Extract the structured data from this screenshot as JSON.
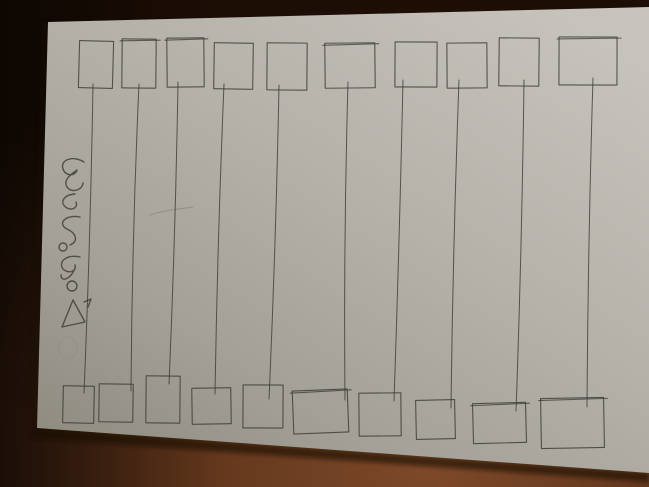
{
  "scene": {
    "description": "Photograph of a sheet of paper on a wooden table with a hand-drawn matching worksheet: ten squares along the top edge joined by long vertical pen lines to ten squares along the bottom edge; a small handwritten Sinhala label runs sideways in the left margin.",
    "handwriting": {
      "transcription": "ගලපමු",
      "script": "Sinhala",
      "orientation": "rotated 90° (reads along left margin)",
      "extra_marks": "small triangle with a tick flag, faint circle below"
    }
  },
  "colors": {
    "table_highlight": "#7d4929",
    "table_mid": "#5d3319",
    "table_dark": "#351c0d",
    "table_darkest": "#1d0e05",
    "paper_dark": "#8a877c",
    "paper_mid1": "#a3a098",
    "paper_mid2": "#b4b1a9",
    "paper_bright": "#c6c3bc",
    "ink": "#3b3a35",
    "ink_faint": "#8e8b82",
    "shadow": "#140a04"
  },
  "paper": {
    "corners": "48,22 649,7 649,473 37,428",
    "bottom_shadow": "37,428 649,473 649,482 29,438",
    "left_shadow": "48,22 37,428 29,426 42,23"
  },
  "drawing": {
    "box_format": "x,y,w,h,rotation_deg,double_top_stroke",
    "top_boxes": [
      [
        79,
        41,
        34,
        47,
        1.5,
        0
      ],
      [
        122,
        39,
        34,
        49,
        0.5,
        1
      ],
      [
        167,
        38,
        37,
        49,
        -0.5,
        1
      ],
      [
        214,
        43,
        39,
        46,
        0.8,
        0
      ],
      [
        267,
        43,
        40,
        47,
        0.4,
        0
      ],
      [
        325,
        43,
        50,
        45,
        -0.6,
        1
      ],
      [
        395,
        42,
        42,
        45,
        0.3,
        0
      ],
      [
        447,
        43,
        40,
        45,
        -0.4,
        0
      ],
      [
        499,
        38,
        40,
        48,
        0.6,
        0
      ],
      [
        559,
        37,
        58,
        48,
        0.2,
        1
      ]
    ],
    "bottom_boxes": [
      [
        63,
        386,
        31,
        37,
        1.2,
        0
      ],
      [
        99,
        384,
        34,
        38,
        0.8,
        0
      ],
      [
        146,
        376,
        34,
        47,
        0.5,
        0
      ],
      [
        192,
        388,
        39,
        36,
        -0.8,
        0
      ],
      [
        243,
        385,
        40,
        43,
        0.3,
        0
      ],
      [
        293,
        390,
        55,
        43,
        -2.2,
        1
      ],
      [
        359,
        393,
        42,
        43,
        -0.5,
        0
      ],
      [
        416,
        400,
        39,
        39,
        -1.2,
        0
      ],
      [
        473,
        403,
        53,
        40,
        -1.5,
        1
      ],
      [
        541,
        398,
        63,
        50,
        -1.0,
        1
      ]
    ],
    "connector_format": "x1,y1,x2,y2,bow",
    "connectors": [
      [
        93,
        84,
        84,
        393,
        2
      ],
      [
        139,
        84,
        131,
        391,
        -3
      ],
      [
        178,
        82,
        169,
        384,
        2
      ],
      [
        224,
        84,
        215,
        394,
        -2
      ],
      [
        279,
        85,
        269,
        399,
        2
      ],
      [
        348,
        82,
        345,
        400,
        -3
      ],
      [
        403,
        80,
        394,
        401,
        1
      ],
      [
        459,
        80,
        451,
        408,
        -2
      ],
      [
        524,
        80,
        516,
        411,
        2
      ],
      [
        593,
        78,
        587,
        407,
        -2
      ]
    ],
    "handwriting_strokes": [
      "M84,162 C72,155 60,160 63,169 C65,176 75,177 77,170 C70,175 63,180 67,187 C71,193 82,191 83,183",
      "M75,194 C63,195 59,203 67,208 C73,211 78,207 76,202",
      "M80,217 C65,214 57,224 67,229 C76,233 79,241 70,245",
      "M80,257 C66,254 58,262 63,269 C68,274 77,272 75,265 M75,268 C71,279 61,283 61,275",
      "M73,300 L62,327 L85,322 Z",
      "M84,302 L91,299 L88,307"
    ],
    "handwriting_rings": [
      [
        63,
        247,
        4
      ],
      [
        72,
        286,
        5
      ]
    ],
    "faint_ring": [
      68,
      348,
      9,
      11
    ],
    "smudge": "M150,215 C165,210 180,209 193,207"
  }
}
